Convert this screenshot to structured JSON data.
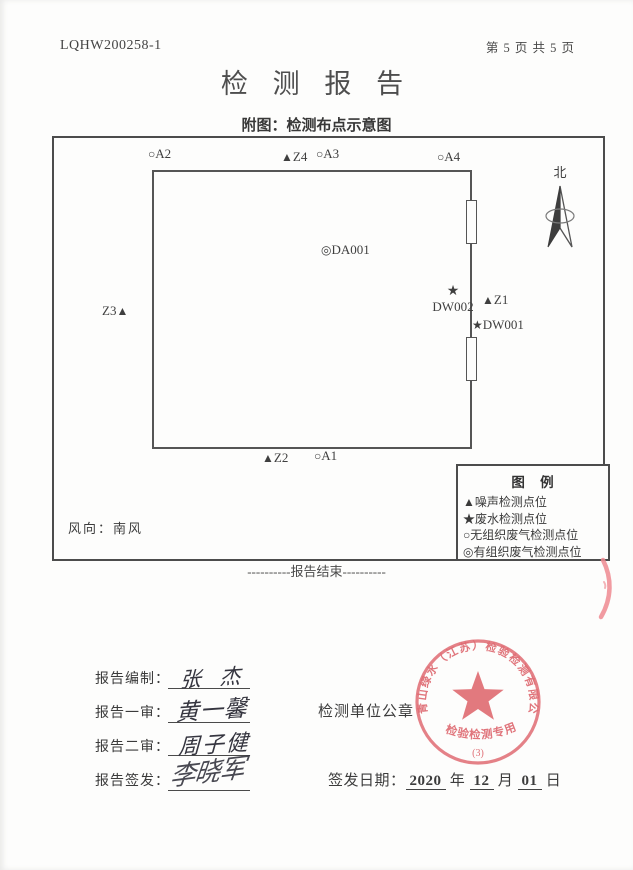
{
  "header": {
    "report_code": "LQHW200258-1",
    "page_info": "第 5 页 共 5 页"
  },
  "title": "检 测 报 告",
  "subtitle": "附图：检测布点示意图",
  "diagram": {
    "north_label": "北",
    "wind_label": "风向：南风",
    "points": {
      "a2": {
        "symbol": "○",
        "label": "A2"
      },
      "z4": {
        "symbol": "▲",
        "label": "Z4"
      },
      "a3": {
        "symbol": "○",
        "label": "A3"
      },
      "a4": {
        "symbol": "○",
        "label": "A4"
      },
      "da001": {
        "symbol": "◎",
        "label": "DA001"
      },
      "z3": {
        "symbol": "▲",
        "label": "Z3"
      },
      "dw002": {
        "symbol": "★",
        "label": "DW002"
      },
      "z1": {
        "symbol": "▲",
        "label": "Z1"
      },
      "dw001": {
        "symbol": "★",
        "label": "DW001"
      },
      "z2": {
        "symbol": "▲",
        "label": "Z2"
      },
      "a1": {
        "symbol": "○",
        "label": "A1"
      }
    },
    "legend": {
      "title": "图  例",
      "items": [
        "▲噪声检测点位",
        "★废水检测点位",
        "○无组织废气检测点位",
        "◎有组织废气检测点位"
      ]
    }
  },
  "report_end": "----------报告结束----------",
  "signatures": [
    {
      "label": "报告编制：",
      "name": "张 杰"
    },
    {
      "label": "报告一审：",
      "name": "黄一馨"
    },
    {
      "label": "报告二审：",
      "name": "周子健"
    },
    {
      "label": "报告签发：",
      "name": "李晓军"
    }
  ],
  "stamp_section": {
    "label": "检测单位公章",
    "issue_date": {
      "label": "签发日期：",
      "year": "2020",
      "year_unit": "年",
      "month": "12",
      "month_unit": "月",
      "day": "01",
      "day_unit": "日"
    }
  },
  "seal": {
    "company": "青山绿水（江苏）检验检测有限公司",
    "type_text": "检验检测专用章",
    "number": "(3)"
  },
  "colors": {
    "seal_red": "#e0606a",
    "line_dark": "#4c4c4c",
    "text": "#3c3c3c"
  }
}
